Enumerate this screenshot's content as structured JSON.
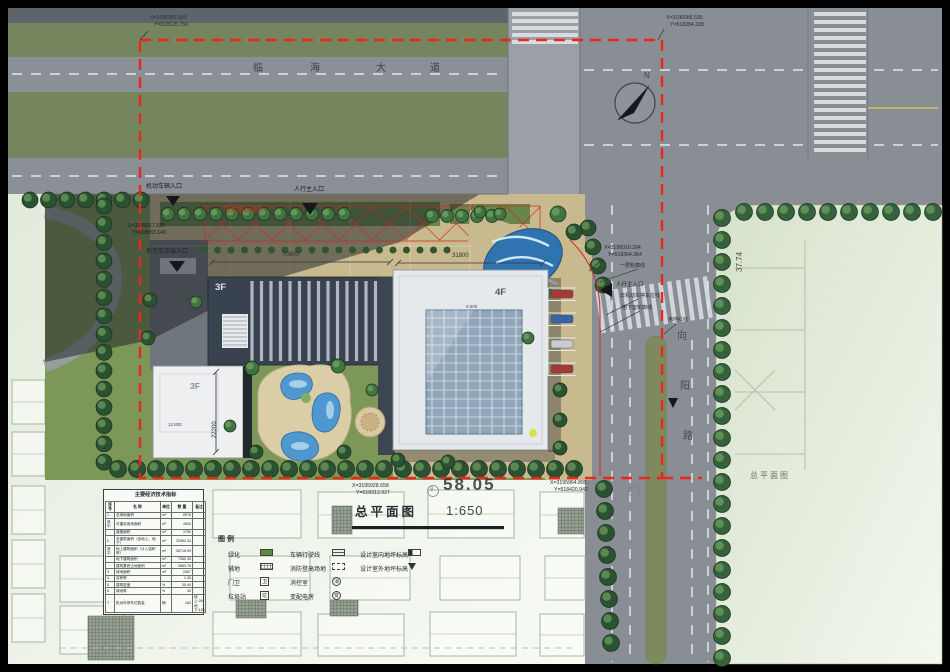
{
  "titles": {
    "main": "总平面图",
    "scale": "1:650",
    "side": "总平面图"
  },
  "roads": {
    "top_name": [
      "临",
      "海",
      "大",
      "道"
    ],
    "right_name": [
      "向",
      "阳",
      "路"
    ]
  },
  "coords": {
    "tl_x": "X=3195985.500",
    "tl_y": "Y=518525.759",
    "tr_x": "X=3196086.535",
    "tr_y": "Y=518384.338",
    "right_x": "X=3196010.294",
    "right_y": "Y=518364.364",
    "left_x": "X=3195917.930",
    "left_y": "Y=518083.143",
    "bl_x": "X=3195928.658",
    "bl_y": "Y=518313.927",
    "br_x": "X=3195964.895",
    "br_y": "Y=518420.942"
  },
  "annotations": {
    "entrance_vehicle": "机动车辆入口",
    "entrance_ped": "人行主入口",
    "entrance_garage": "地下车库出入口",
    "entrance_ped_side": "人行主入口",
    "fire_lane": "消防登高场地",
    "outline_floor1": "一层轮廓线",
    "outline_bike": "非机动车停车位线",
    "outline_basement": "地下室轮廓线",
    "red_line": "用地红线",
    "floors_left": "3F",
    "floors_right": "4F",
    "floors_annex": "3F",
    "dim_left": "70800",
    "dim_right": "31800",
    "dim_annex": "22200",
    "dim_site_width": "58.05",
    "dim_parcel": "37.74",
    "elev_plaza": "0.500",
    "elev_annex": "12.800",
    "north": "N"
  },
  "ghost_axis": [
    "8",
    "10"
  ],
  "table": {
    "title": "主要经济技术指标",
    "headers": [
      "序号",
      "名  称",
      "单位",
      "数  量",
      "备注"
    ],
    "rows": [
      [
        "1",
        "总用地面积",
        "m²",
        "8976",
        ""
      ],
      [
        "其中",
        "可建设用地面积",
        "m²",
        "4500",
        ""
      ],
      [
        "",
        "道路面积",
        "m²",
        "1790",
        ""
      ],
      [
        "2",
        "总建筑面积（含地上、地下）",
        "m²",
        "32592.34",
        ""
      ],
      [
        "其中",
        "地上建筑面积（计入容积率）",
        "m²",
        "26718.99",
        ""
      ],
      [
        "",
        "地下建筑面积",
        "m²",
        "7080.35",
        ""
      ],
      [
        "",
        "建筑基底占地面积",
        "m²",
        "3883.76",
        ""
      ],
      [
        "3",
        "绿地面积",
        "m²",
        "2067",
        ""
      ],
      [
        "4",
        "容积率",
        "",
        "1.35",
        ""
      ],
      [
        "5",
        "建筑密度",
        "%",
        "35.40",
        ""
      ],
      [
        "6",
        "绿地率",
        "%",
        "30",
        ""
      ],
      [
        "7",
        "机动车停车位数量",
        "辆",
        "163",
        "地上:28 地下:135"
      ]
    ]
  },
  "legend": {
    "title": "图例",
    "col1": [
      {
        "label": "绿化",
        "swatch": "green",
        "char": ""
      },
      {
        "label": "铺地",
        "swatch": "hatch",
        "char": ""
      },
      {
        "label": "门卫",
        "swatch": "box",
        "char": "卫"
      },
      {
        "label": "垃圾站",
        "swatch": "box",
        "char": "垃"
      }
    ],
    "col2": [
      {
        "label": "车辆行驶线",
        "swatch": "line",
        "char": ""
      },
      {
        "label": "消防登高场地",
        "swatch": "dashed",
        "char": ""
      },
      {
        "label": "消控室",
        "swatch": "circle",
        "char": "消"
      },
      {
        "label": "变配电房",
        "swatch": "circle",
        "char": "变"
      }
    ],
    "col3": [
      {
        "label": "设计室内地坪标高",
        "swatch": "elev-in",
        "char": ""
      },
      {
        "label": "设计室外地坪标高",
        "swatch": "elev-out",
        "char": ""
      }
    ]
  },
  "colors": {
    "boundary_red": "#e8281e",
    "road_gray": "#8b9096",
    "lawn_green": "#7c9757",
    "plaza_tan": "#c8ba8e",
    "tree_green": "#2a5132",
    "water_blue": "#4f97cf",
    "parcel_green": "#e3ecdc"
  }
}
